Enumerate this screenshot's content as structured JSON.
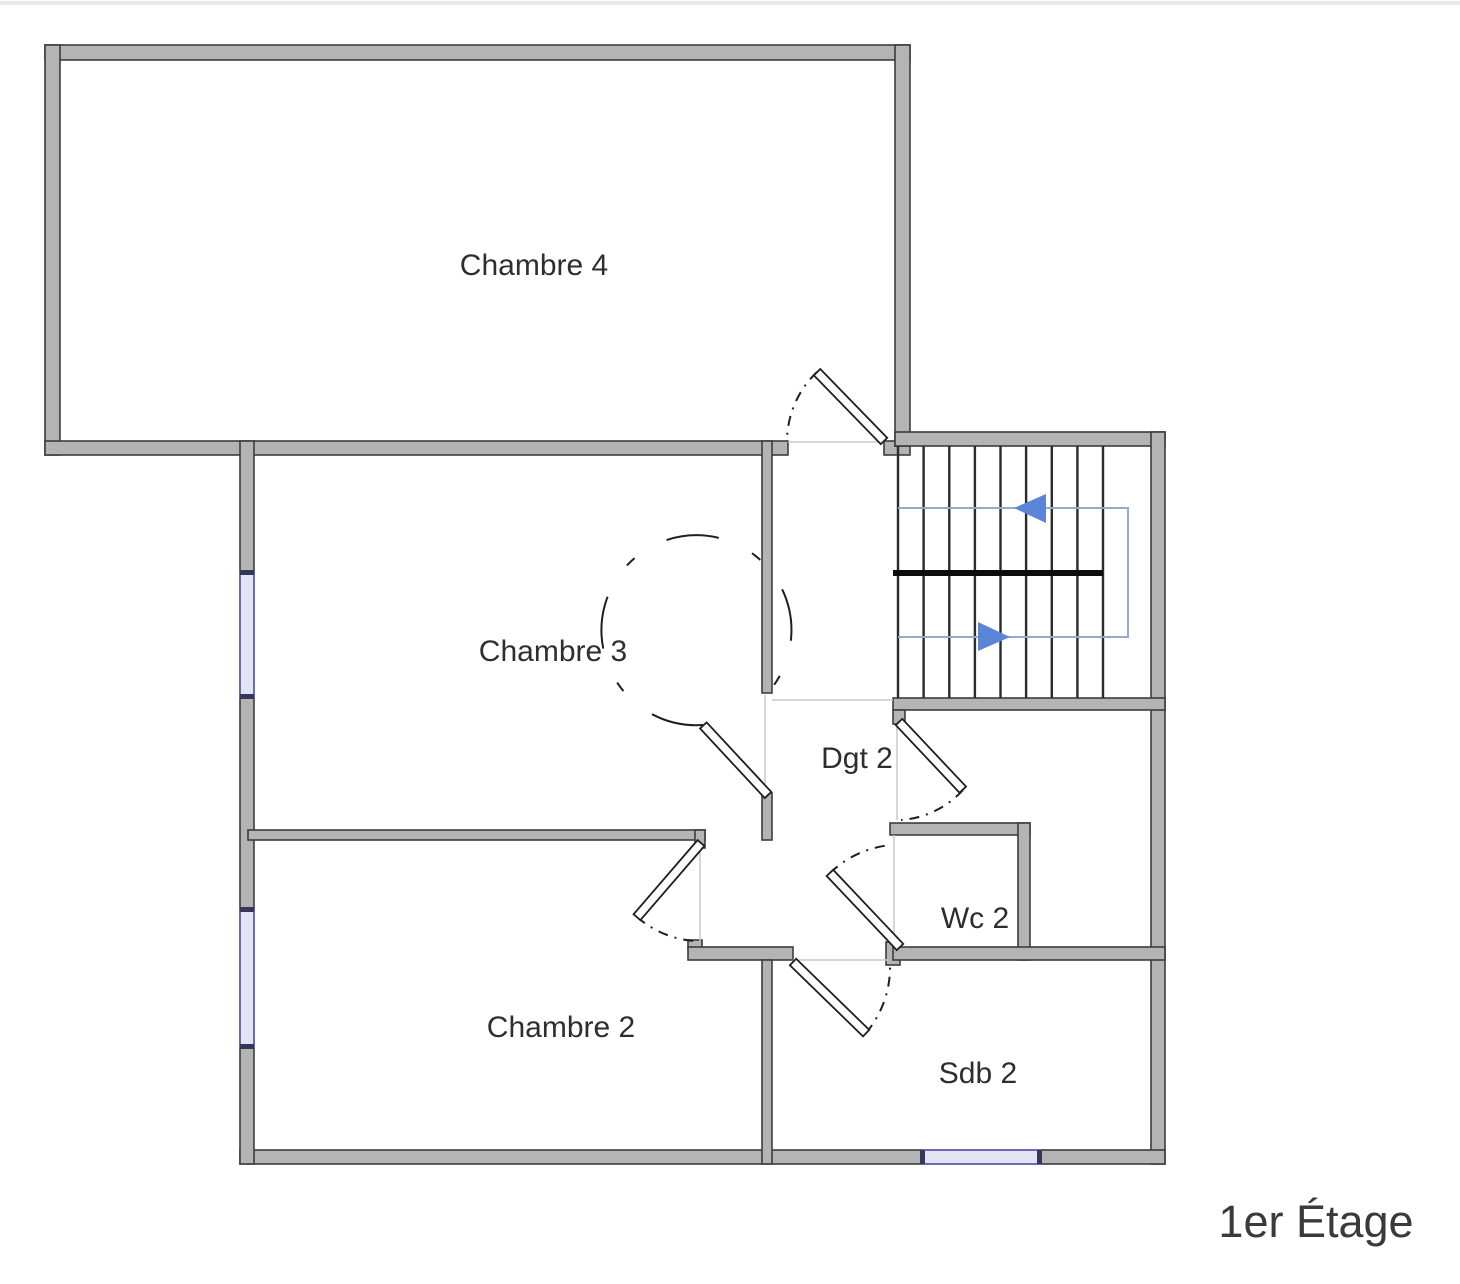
{
  "page": {
    "floor_title": "1er Étage"
  },
  "plan": {
    "rooms": [
      {
        "id": "chambre-4",
        "label": "Chambre 4"
      },
      {
        "id": "chambre-3",
        "label": "Chambre 3"
      },
      {
        "id": "chambre-2",
        "label": "Chambre 2"
      },
      {
        "id": "dgt-2",
        "label": "Dgt 2"
      },
      {
        "id": "wc-2",
        "label": "Wc 2"
      },
      {
        "id": "sdb-2",
        "label": "Sdb 2"
      }
    ],
    "stairs": {
      "up_arrow_direction": "left",
      "down_arrow_direction": "right"
    },
    "windows_count": 3,
    "doors_count": 6,
    "colors": {
      "wall_fill": "#b4b4b4",
      "wall_stroke": "#3d3d3d",
      "window_fill": "#e3e3f4",
      "window_stroke": "#6b6bb4",
      "stair_tread": "#2b2b2b",
      "stair_divider": "#0d0d0d",
      "stair_path": "#94aacd",
      "stair_arrow": "#5b85d6",
      "label_text": "#2e2e2e",
      "title_text": "#3a3a3a"
    }
  }
}
